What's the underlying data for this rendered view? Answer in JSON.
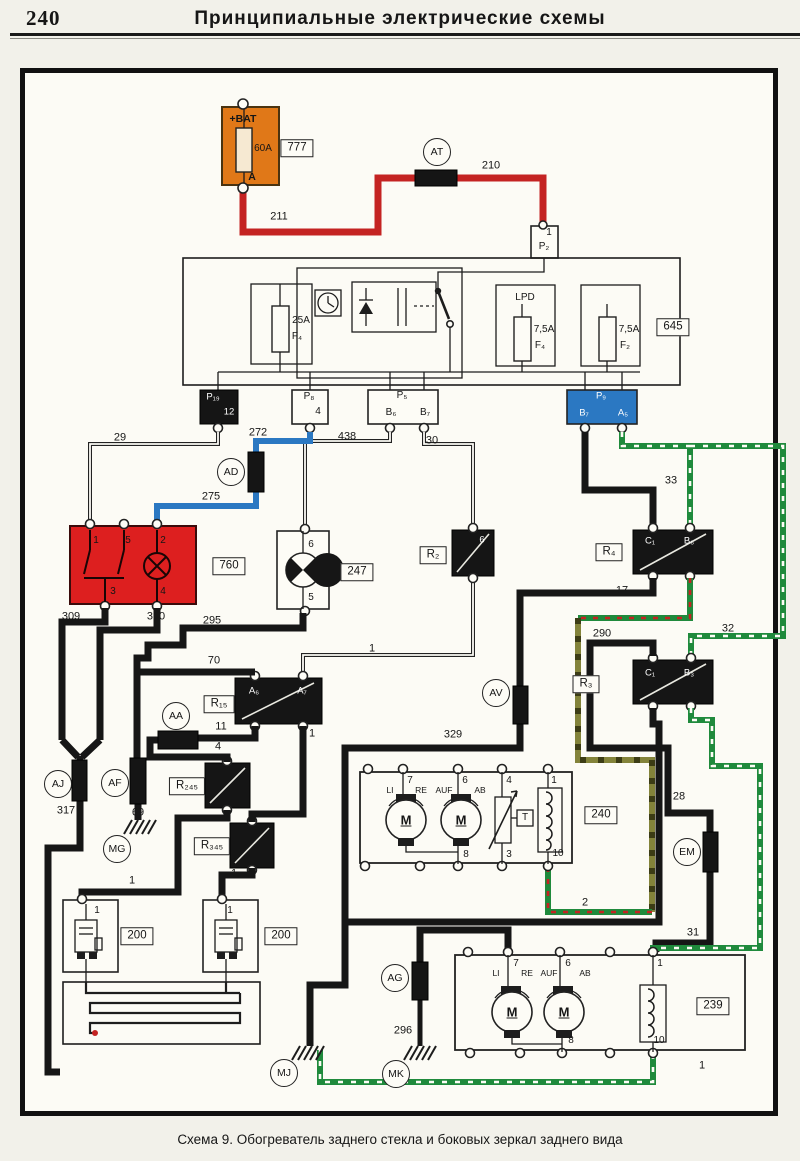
{
  "page": {
    "number": "240",
    "title": "Принципиальные  электрические  схемы",
    "caption": "Схема 9. Обогреватель заднего стекла и боковых зеркал заднего вида"
  },
  "colors": {
    "battery_orange": "#e07818",
    "switch_red": "#dd1f1f",
    "wire_red": "#c42322",
    "wire_blue": "#2b78c2",
    "wire_green": "#1f8a3c",
    "wire_olive": "#83833a",
    "connector_blue": "#2b78c2"
  },
  "labels": [
    {
      "t": "+BAT",
      "x": 243,
      "y": 119,
      "c": "plb",
      "n": "battery-plus-label"
    },
    {
      "t": "60A",
      "x": 263,
      "y": 149,
      "c": "pl",
      "n": "battery-fuse-rating"
    },
    {
      "t": "A",
      "x": 252,
      "y": 177,
      "c": "plb",
      "n": "battery-terminal-a"
    },
    {
      "t": "777",
      "x": 297,
      "y": 148,
      "c": "bx",
      "n": "component-tag-777"
    },
    {
      "t": "AT",
      "x": 437,
      "y": 152,
      "c": "ci",
      "n": "connector-at"
    },
    {
      "t": "210",
      "x": 491,
      "y": 166,
      "c": "w",
      "n": "wire-210"
    },
    {
      "t": "211",
      "x": 279,
      "y": 217,
      "c": "w",
      "n": "wire-211"
    },
    {
      "t": "1",
      "x": 549,
      "y": 233,
      "c": "pl",
      "n": "pin-p2-1"
    },
    {
      "t": "P₂",
      "x": 544,
      "y": 247,
      "c": "pl",
      "n": "connector-p2"
    },
    {
      "t": "645",
      "x": 673,
      "y": 327,
      "c": "bx",
      "n": "component-tag-645"
    },
    {
      "t": "25A",
      "x": 301,
      "y": 321,
      "c": "pl",
      "n": "fuse-25a"
    },
    {
      "t": "F₄",
      "x": 297,
      "y": 337,
      "c": "pl",
      "n": "fuse-f4"
    },
    {
      "t": "LPD",
      "x": 525,
      "y": 298,
      "c": "pl",
      "n": "lpd-label"
    },
    {
      "t": "7,5A",
      "x": 544,
      "y": 330,
      "c": "pl",
      "n": "fuse-75a-left"
    },
    {
      "t": "F₄",
      "x": 540,
      "y": 346,
      "c": "pl",
      "n": "fuse-f4-right"
    },
    {
      "t": "7,5A",
      "x": 629,
      "y": 330,
      "c": "pl",
      "n": "fuse-75a-right"
    },
    {
      "t": "F₂",
      "x": 625,
      "y": 346,
      "c": "pl",
      "n": "fuse-f2"
    },
    {
      "t": "P₁₉",
      "x": 213,
      "y": 397,
      "c": "wh",
      "n": "connector-p19"
    },
    {
      "t": "12",
      "x": 229,
      "y": 412,
      "c": "wh",
      "n": "pin-p19-12"
    },
    {
      "t": "P₈",
      "x": 309,
      "y": 397,
      "c": "pl",
      "n": "connector-p8"
    },
    {
      "t": "4",
      "x": 318,
      "y": 412,
      "c": "pl",
      "n": "pin-p8-4"
    },
    {
      "t": "P₅",
      "x": 402,
      "y": 396,
      "c": "pl",
      "n": "connector-p5"
    },
    {
      "t": "B₆",
      "x": 391,
      "y": 413,
      "c": "pl",
      "n": "pin-p5-b6"
    },
    {
      "t": "B₇",
      "x": 425,
      "y": 413,
      "c": "pl",
      "n": "pin-p5-b7"
    },
    {
      "t": "P₉",
      "x": 601,
      "y": 396,
      "c": "wh",
      "n": "connector-p9"
    },
    {
      "t": "B₇",
      "x": 584,
      "y": 413,
      "c": "wh",
      "n": "pin-p9-b7"
    },
    {
      "t": "A₅",
      "x": 623,
      "y": 413,
      "c": "wh",
      "n": "pin-p9-a5"
    },
    {
      "t": "29",
      "x": 120,
      "y": 438,
      "c": "w",
      "n": "wire-29"
    },
    {
      "t": "272",
      "x": 258,
      "y": 433,
      "c": "w",
      "n": "wire-272"
    },
    {
      "t": "438",
      "x": 347,
      "y": 437,
      "c": "w",
      "n": "wire-438"
    },
    {
      "t": "30",
      "x": 432,
      "y": 441,
      "c": "w",
      "n": "wire-30"
    },
    {
      "t": "33",
      "x": 671,
      "y": 481,
      "c": "w",
      "n": "wire-33"
    },
    {
      "t": "AD",
      "x": 231,
      "y": 472,
      "c": "ci",
      "n": "connector-ad"
    },
    {
      "t": "275",
      "x": 211,
      "y": 497,
      "c": "w",
      "n": "wire-275"
    },
    {
      "t": "760",
      "x": 229,
      "y": 566,
      "c": "bx",
      "n": "component-tag-760"
    },
    {
      "t": "1",
      "x": 96,
      "y": 541,
      "c": "pl",
      "n": "pin-760-1"
    },
    {
      "t": "5",
      "x": 128,
      "y": 541,
      "c": "pl",
      "n": "pin-760-5"
    },
    {
      "t": "2",
      "x": 163,
      "y": 541,
      "c": "pl",
      "n": "pin-760-2"
    },
    {
      "t": "3",
      "x": 113,
      "y": 592,
      "c": "pl",
      "n": "pin-760-3"
    },
    {
      "t": "4",
      "x": 163,
      "y": 592,
      "c": "pl",
      "n": "pin-760-4"
    },
    {
      "t": "247",
      "x": 357,
      "y": 572,
      "c": "bx",
      "n": "component-tag-247"
    },
    {
      "t": "6",
      "x": 311,
      "y": 545,
      "c": "pl",
      "n": "pin-247-6"
    },
    {
      "t": "5",
      "x": 311,
      "y": 598,
      "c": "pl",
      "n": "pin-247-5"
    },
    {
      "t": "R₂",
      "x": 433,
      "y": 555,
      "c": "bx",
      "n": "component-tag-r2"
    },
    {
      "t": "6",
      "x": 482,
      "y": 540,
      "c": "wh",
      "n": "pin-r2-6"
    },
    {
      "t": "R₄",
      "x": 609,
      "y": 552,
      "c": "bx",
      "n": "component-tag-r4"
    },
    {
      "t": "C₁",
      "x": 650,
      "y": 541,
      "c": "wh",
      "n": "pin-r4-c1"
    },
    {
      "t": "B₆",
      "x": 689,
      "y": 541,
      "c": "wh",
      "n": "pin-r4-b6"
    },
    {
      "t": "309",
      "x": 71,
      "y": 617,
      "c": "w",
      "n": "wire-309"
    },
    {
      "t": "310",
      "x": 156,
      "y": 617,
      "c": "w",
      "n": "wire-310"
    },
    {
      "t": "295",
      "x": 212,
      "y": 621,
      "c": "w",
      "n": "wire-295"
    },
    {
      "t": "17",
      "x": 622,
      "y": 591,
      "c": "w",
      "n": "wire-17"
    },
    {
      "t": "290",
      "x": 602,
      "y": 634,
      "c": "w",
      "n": "wire-290"
    },
    {
      "t": "32",
      "x": 728,
      "y": 629,
      "c": "w",
      "n": "wire-32"
    },
    {
      "t": "R₃",
      "x": 586,
      "y": 684,
      "c": "bx",
      "n": "component-tag-r3"
    },
    {
      "t": "C₁",
      "x": 650,
      "y": 673,
      "c": "wh",
      "n": "pin-r3-c1"
    },
    {
      "t": "B₃",
      "x": 689,
      "y": 673,
      "c": "wh",
      "n": "pin-r3-b3"
    },
    {
      "t": "70",
      "x": 214,
      "y": 661,
      "c": "w",
      "n": "wire-70"
    },
    {
      "t": "1",
      "x": 372,
      "y": 649,
      "c": "w",
      "n": "wire-1-r2-r15"
    },
    {
      "t": "R₁₅",
      "x": 219,
      "y": 704,
      "c": "bx",
      "n": "component-tag-r15"
    },
    {
      "t": "A₆",
      "x": 254,
      "y": 691,
      "c": "wh",
      "n": "pin-r15-a6"
    },
    {
      "t": "A₇",
      "x": 302,
      "y": 691,
      "c": "wh",
      "n": "pin-r15-a7"
    },
    {
      "t": "AA",
      "x": 176,
      "y": 716,
      "c": "ci",
      "n": "connector-aa"
    },
    {
      "t": "11",
      "x": 221,
      "y": 727,
      "c": "w",
      "n": "wire-11"
    },
    {
      "t": "4",
      "x": 218,
      "y": 747,
      "c": "w",
      "n": "wire-4"
    },
    {
      "t": "1",
      "x": 312,
      "y": 734,
      "c": "w",
      "n": "wire-1-r15-r345"
    },
    {
      "t": "AV",
      "x": 496,
      "y": 693,
      "c": "ci",
      "n": "connector-av"
    },
    {
      "t": "329",
      "x": 453,
      "y": 735,
      "c": "w",
      "n": "wire-329"
    },
    {
      "t": "AJ",
      "x": 58,
      "y": 784,
      "c": "ci",
      "n": "connector-aj"
    },
    {
      "t": "AF",
      "x": 115,
      "y": 783,
      "c": "ci",
      "n": "connector-af"
    },
    {
      "t": "R₂₄₅",
      "x": 187,
      "y": 786,
      "c": "bx",
      "n": "component-tag-r245"
    },
    {
      "t": "317",
      "x": 66,
      "y": 811,
      "c": "w",
      "n": "wire-317"
    },
    {
      "t": "69",
      "x": 138,
      "y": 813,
      "c": "w",
      "n": "wire-69"
    },
    {
      "t": "MG",
      "x": 117,
      "y": 849,
      "c": "ci",
      "n": "ground-mg"
    },
    {
      "t": "R₃₄₅",
      "x": 212,
      "y": 846,
      "c": "bx",
      "n": "component-tag-r345"
    },
    {
      "t": "28",
      "x": 679,
      "y": 797,
      "c": "w",
      "n": "wire-28"
    },
    {
      "t": "EM",
      "x": 687,
      "y": 852,
      "c": "ci",
      "n": "connector-em"
    },
    {
      "t": "240",
      "x": 601,
      "y": 815,
      "c": "bx",
      "n": "component-tag-240"
    },
    {
      "t": "7",
      "x": 410,
      "y": 781,
      "c": "pl",
      "n": "pin-240-7"
    },
    {
      "t": "6",
      "x": 465,
      "y": 781,
      "c": "pl",
      "n": "pin-240-6"
    },
    {
      "t": "4",
      "x": 509,
      "y": 781,
      "c": "pl",
      "n": "pin-240-4"
    },
    {
      "t": "1",
      "x": 554,
      "y": 781,
      "c": "pl",
      "n": "pin-240-1"
    },
    {
      "t": "LI",
      "x": 390,
      "y": 790,
      "c": "p9",
      "n": "label-li-240"
    },
    {
      "t": "RE",
      "x": 421,
      "y": 790,
      "c": "p9",
      "n": "label-re-240"
    },
    {
      "t": "AUF",
      "x": 444,
      "y": 790,
      "c": "p9",
      "n": "label-auf-240"
    },
    {
      "t": "AB",
      "x": 480,
      "y": 790,
      "c": "p9",
      "n": "label-ab-240"
    },
    {
      "t": "M",
      "x": 406,
      "y": 820,
      "c": "m",
      "n": "motor-left-240"
    },
    {
      "t": "M",
      "x": 461,
      "y": 820,
      "c": "m",
      "n": "motor-right-240"
    },
    {
      "t": "T",
      "x": 525,
      "y": 818,
      "c": "pl",
      "n": "sensor-t-240"
    },
    {
      "t": "8",
      "x": 466,
      "y": 855,
      "c": "pl",
      "n": "pin-240-8"
    },
    {
      "t": "3",
      "x": 509,
      "y": 855,
      "c": "pl",
      "n": "pin-240-3"
    },
    {
      "t": "10",
      "x": 558,
      "y": 854,
      "c": "pl",
      "n": "pin-240-10"
    },
    {
      "t": "2",
      "x": 585,
      "y": 903,
      "c": "w",
      "n": "wire-2"
    },
    {
      "t": "31",
      "x": 693,
      "y": 933,
      "c": "w",
      "n": "wire-31"
    },
    {
      "t": "1",
      "x": 132,
      "y": 881,
      "c": "w",
      "n": "wire-1-left200"
    },
    {
      "t": "1",
      "x": 234,
      "y": 874,
      "c": "w",
      "n": "wire-1-right200"
    },
    {
      "t": "200",
      "x": 137,
      "y": 936,
      "c": "bx",
      "n": "component-tag-200-left"
    },
    {
      "t": "200",
      "x": 281,
      "y": 936,
      "c": "bx",
      "n": "component-tag-200-right"
    },
    {
      "t": "1",
      "x": 97,
      "y": 911,
      "c": "pl",
      "n": "pin-200l-1"
    },
    {
      "t": "1",
      "x": 230,
      "y": 911,
      "c": "pl",
      "n": "pin-200r-1"
    },
    {
      "t": "AG",
      "x": 395,
      "y": 978,
      "c": "ci",
      "n": "connector-ag"
    },
    {
      "t": "296",
      "x": 403,
      "y": 1031,
      "c": "w",
      "n": "wire-296"
    },
    {
      "t": "MJ",
      "x": 284,
      "y": 1073,
      "c": "ci",
      "n": "ground-mj"
    },
    {
      "t": "MK",
      "x": 396,
      "y": 1074,
      "c": "ci",
      "n": "ground-mk"
    },
    {
      "t": "239",
      "x": 713,
      "y": 1006,
      "c": "bx",
      "n": "component-tag-239"
    },
    {
      "t": "7",
      "x": 516,
      "y": 964,
      "c": "pl",
      "n": "pin-239-7"
    },
    {
      "t": "6",
      "x": 568,
      "y": 964,
      "c": "pl",
      "n": "pin-239-6"
    },
    {
      "t": "1",
      "x": 660,
      "y": 964,
      "c": "pl",
      "n": "pin-239-1"
    },
    {
      "t": "LI",
      "x": 496,
      "y": 973,
      "c": "p9",
      "n": "label-li-239"
    },
    {
      "t": "RE",
      "x": 527,
      "y": 973,
      "c": "p9",
      "n": "label-re-239"
    },
    {
      "t": "AUF",
      "x": 549,
      "y": 973,
      "c": "p9",
      "n": "label-auf-239"
    },
    {
      "t": "AB",
      "x": 585,
      "y": 973,
      "c": "p9",
      "n": "label-ab-239"
    },
    {
      "t": "M",
      "x": 512,
      "y": 1012,
      "c": "m",
      "n": "motor-left-239"
    },
    {
      "t": "M",
      "x": 564,
      "y": 1012,
      "c": "m",
      "n": "motor-right-239"
    },
    {
      "t": "8",
      "x": 571,
      "y": 1041,
      "c": "pl",
      "n": "pin-239-8"
    },
    {
      "t": "10",
      "x": 659,
      "y": 1041,
      "c": "pl",
      "n": "pin-239-10"
    },
    {
      "t": "1",
      "x": 702,
      "y": 1066,
      "c": "w",
      "n": "wire-1-green"
    }
  ]
}
